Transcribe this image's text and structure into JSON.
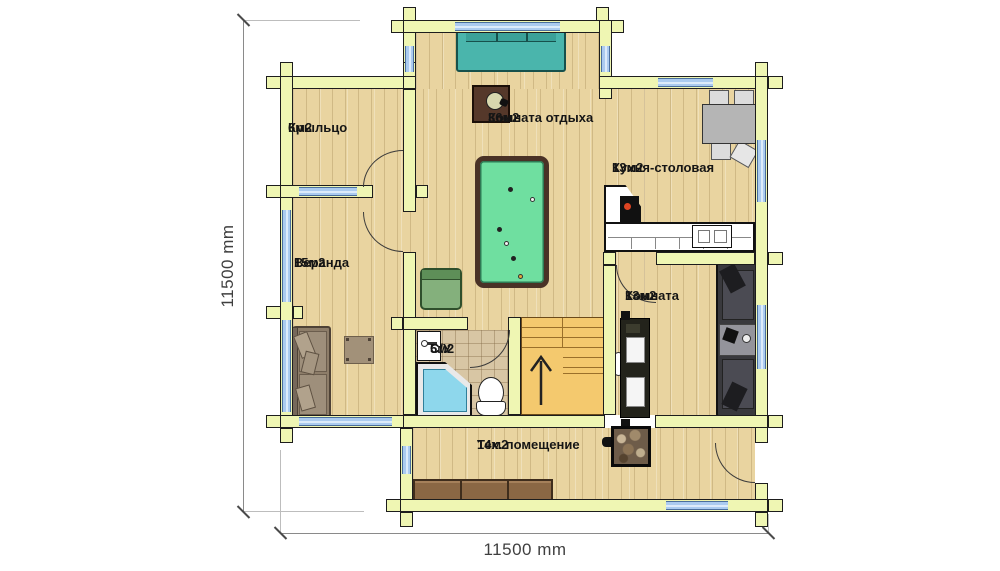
{
  "dimensions": {
    "left": "11500 mm",
    "bottom": "11500 mm"
  },
  "rooms": [
    {
      "name": "Крыльцо",
      "area": "6м2"
    },
    {
      "name": "Комната отдыха",
      "area": "36м2"
    },
    {
      "name": "Кухня-столовая",
      "area": "13м2"
    },
    {
      "name": "Веранда",
      "area": "15м2"
    },
    {
      "name": "Комната",
      "area": "13м2"
    },
    {
      "name": "С/У",
      "area": "5м2"
    },
    {
      "name": "Тех. помещение",
      "area": "14м2"
    }
  ],
  "furniture_icons": [
    "billiard-table",
    "teal-sofa",
    "wall-clock",
    "armchair",
    "dining-table",
    "dining-chair",
    "kitchen-counter",
    "stove",
    "kitchen-sink",
    "dark-sofa",
    "coffee-table",
    "tv-cabinet",
    "fireplace-stove",
    "storage-cabinets",
    "veranda-sofa",
    "side-table",
    "bath-sink",
    "corner-bathtub",
    "toilet",
    "staircase",
    "stairs-up-arrow"
  ],
  "colors": {
    "wall": "#eff6b3",
    "wallOutline": "#1d1d1d",
    "wood": "#e9d4a0",
    "tile": "#d8c6a4",
    "window": "#abcbf0",
    "windowEdge": "#4a6f9d",
    "stairs": "#f4c96e",
    "billiard": "#6fdfa0",
    "billiardFrame": "#4a3226",
    "tealSofa": "#4ab5ac",
    "dimText": "#3f3f3f"
  }
}
